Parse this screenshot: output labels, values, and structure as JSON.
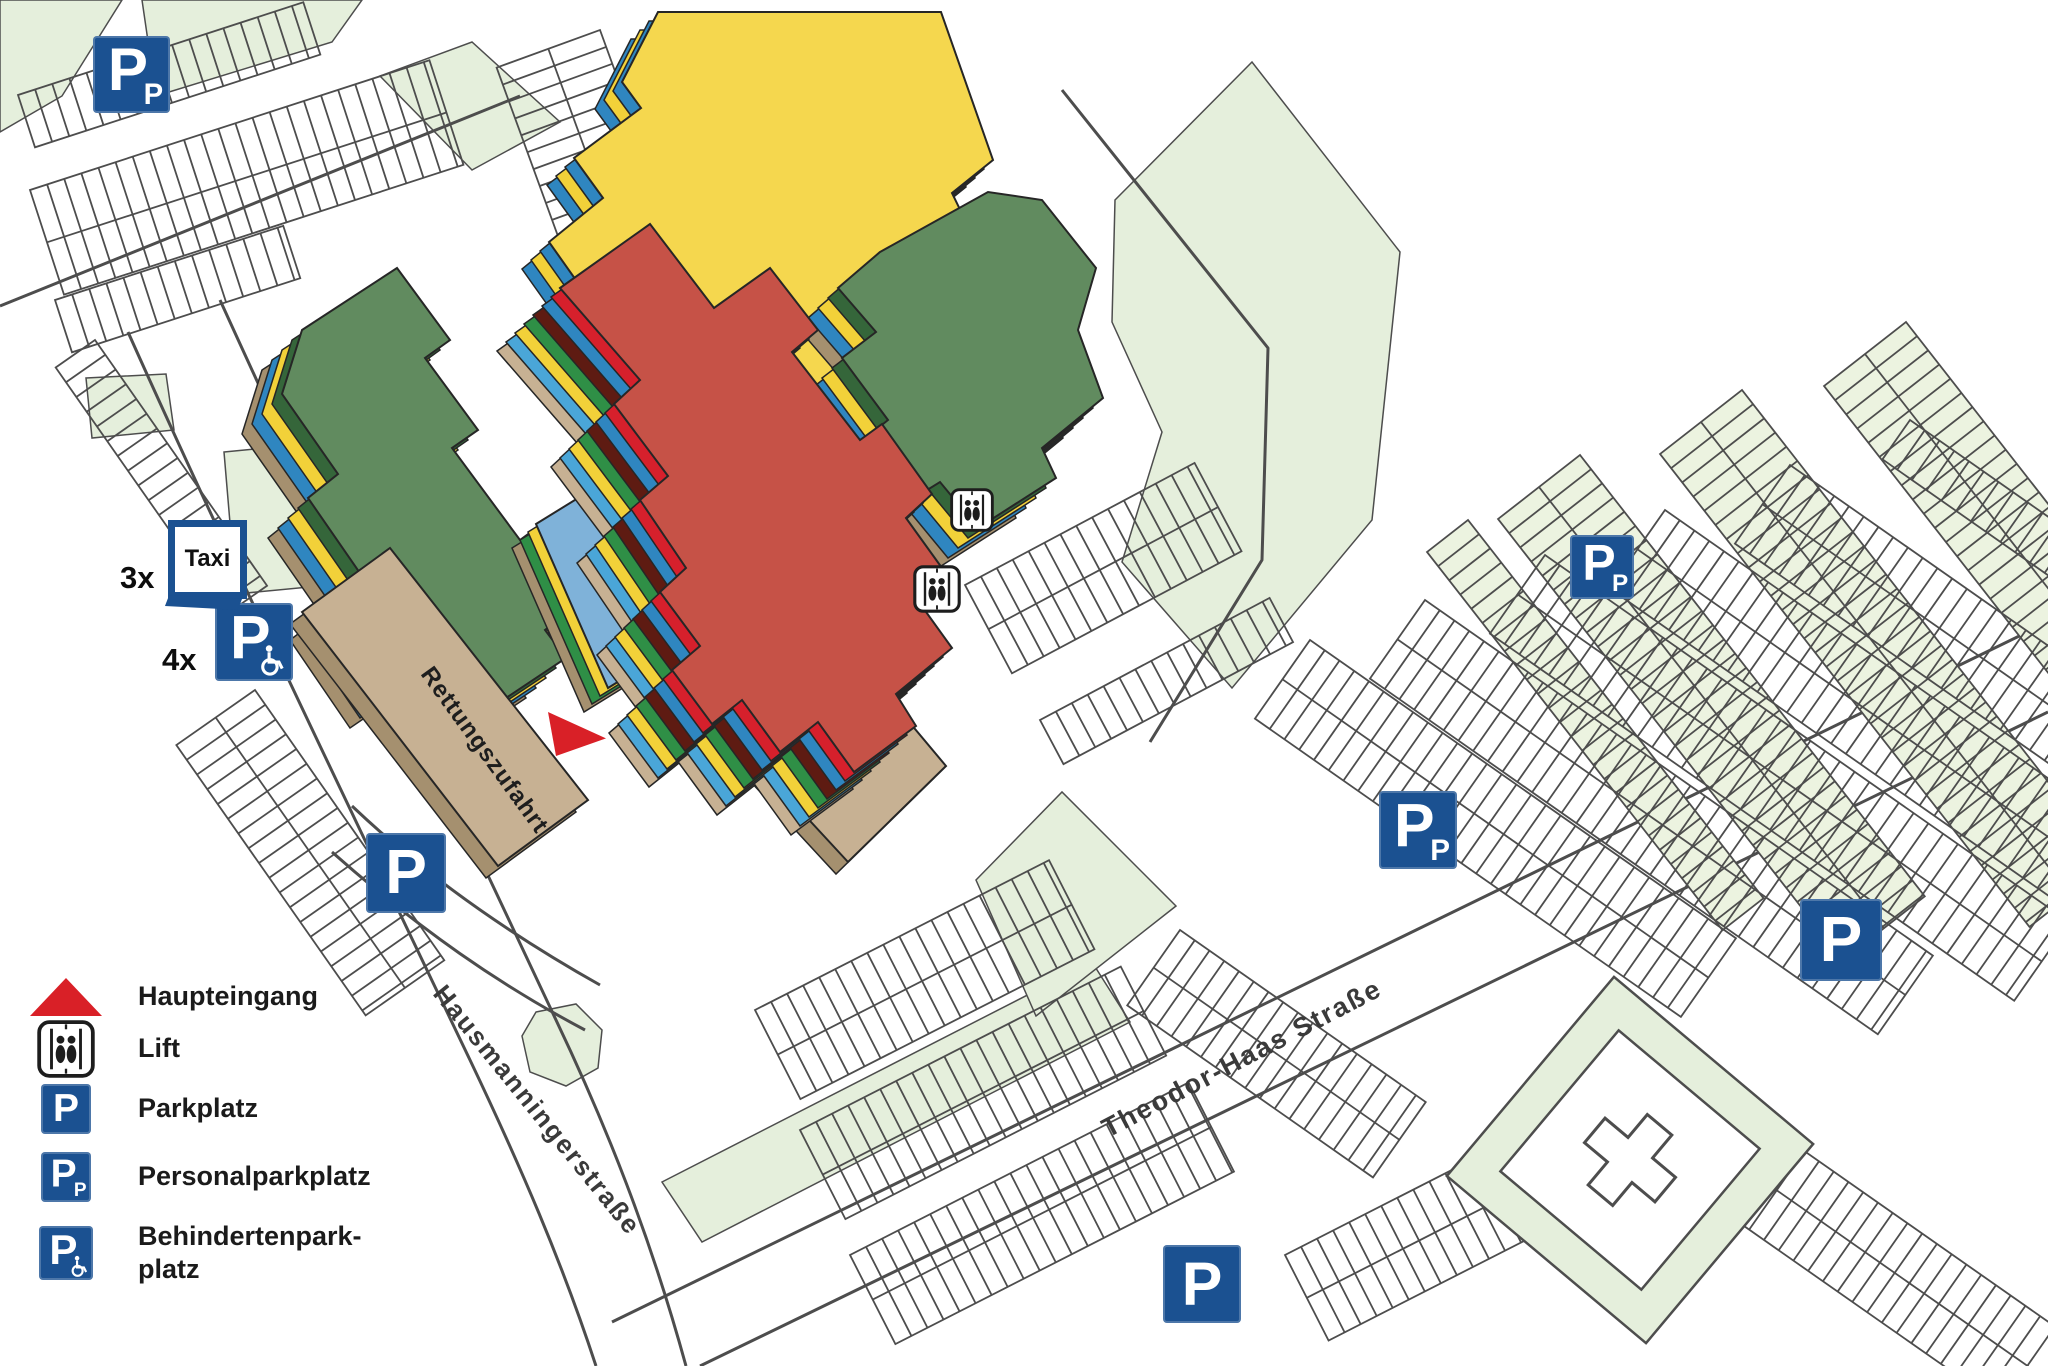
{
  "legend": {
    "items": [
      {
        "id": "main-entrance",
        "icon": "main-entrance-triangle-icon",
        "label": "Haupteingang"
      },
      {
        "id": "lift",
        "icon": "lift-icon",
        "label": "Lift"
      },
      {
        "id": "parking",
        "icon": "parking-sign-icon",
        "label": "Parkplatz"
      },
      {
        "id": "staff-parking",
        "icon": "staff-parking-sign-icon",
        "label": "Personalparkplatz"
      },
      {
        "id": "disabled-parking",
        "icon": "disabled-parking-sign-icon",
        "label": "Behindertenpark-\nplatz"
      }
    ]
  },
  "map": {
    "streets": [
      {
        "name": "Hausmanningerstraße",
        "x": 432,
        "y": 994,
        "angle": 51,
        "font": 26
      },
      {
        "name": "Theodor-Haas Straße",
        "x": 1108,
        "y": 1138,
        "angle": -27.5,
        "font": 27
      }
    ],
    "building_labels": [
      {
        "text": "Rettungszufahrt",
        "x": 420,
        "y": 674,
        "angle": 54,
        "font": 24
      }
    ],
    "markers": {
      "taxi": {
        "label": "Taxi",
        "count": "3x",
        "x": 168,
        "y": 520,
        "size": 79,
        "count_x": 120,
        "count_y": 560
      },
      "disabled_parking": [
        {
          "count": "4x",
          "x": 215,
          "y": 603,
          "size": 78,
          "count_x": 162,
          "count_y": 642
        }
      ],
      "staff_parking": [
        {
          "x": 93,
          "y": 36,
          "size": 77
        },
        {
          "x": 1570,
          "y": 535,
          "size": 64
        },
        {
          "x": 1379,
          "y": 791,
          "size": 78
        }
      ],
      "parking": [
        {
          "x": 366,
          "y": 833,
          "size": 80
        },
        {
          "x": 1163,
          "y": 1245,
          "size": 78
        },
        {
          "x": 1800,
          "y": 899,
          "size": 82
        }
      ],
      "lifts": [
        {
          "x": 950,
          "y": 488,
          "size": 44
        },
        {
          "x": 913,
          "y": 565,
          "size": 48
        }
      ],
      "main_entrance": {
        "x": 544,
        "y": 706,
        "width": 64,
        "height": 54
      }
    },
    "colors": {
      "meadow": "#e5efdc",
      "parking_cell": "#ecf3e0",
      "road_line": "#4d4d4d",
      "outline": "#262626",
      "sign_blue": "#1b5191",
      "entrance_red": "#d92027",
      "building_yellow": "#f5d74e",
      "building_red": "#c65247",
      "building_green": "#618b5f",
      "building_blue": "#7fb2d9",
      "building_tan": "#c7b193",
      "stripe_bright_red": "#d6202c",
      "stripe_blue": "#2f86c0",
      "stripe_light_blue": "#4aa6d8",
      "stripe_yellow": "#f2d139",
      "stripe_green": "#2f8f46",
      "stripe_dark_green": "#35663a",
      "stripe_maroon": "#5e1b12",
      "stripe_dark_tan": "#a5906f"
    }
  }
}
